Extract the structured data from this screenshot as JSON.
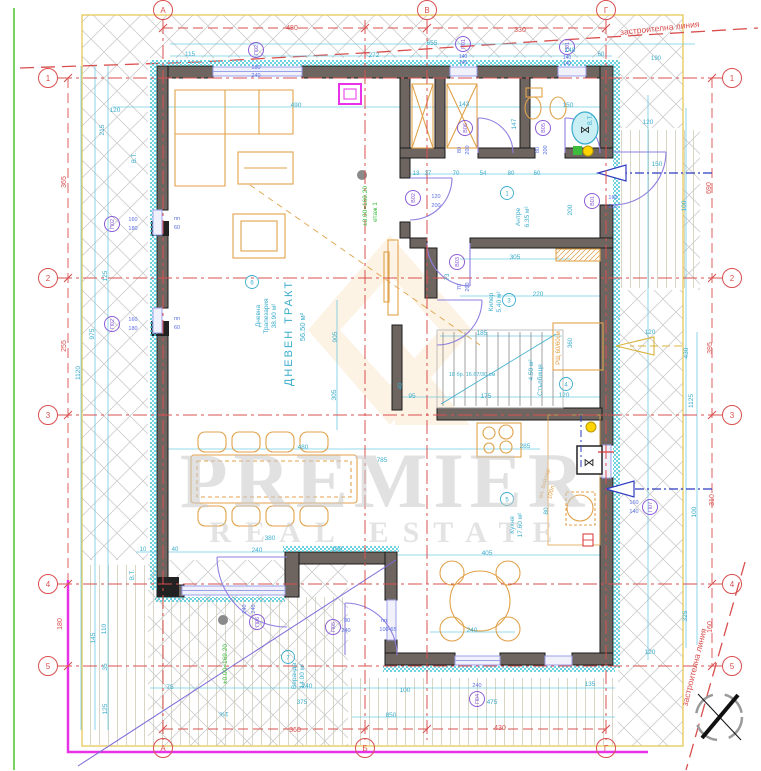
{
  "drawing": {
    "type": "architectural-floor-plan",
    "floor_label": "етаж 1",
    "elevation": "±0.00=169.20"
  },
  "texts": [
    {
      "t": "480",
      "x": 292,
      "y": 30,
      "s": 7,
      "c": "red",
      "n": "dim-red"
    },
    {
      "t": "330",
      "x": 520,
      "y": 32,
      "s": 7,
      "c": "red",
      "n": "dim-red"
    },
    {
      "t": "застроителна линия",
      "x": 660,
      "y": 31,
      "s": 8.5,
      "c": "red",
      "r": -6,
      "n": "building-line-label"
    },
    {
      "t": "застроителна линия",
      "x": 697,
      "y": 668,
      "s": 8.5,
      "c": "red",
      "r": -76,
      "n": "building-line-label"
    },
    {
      "t": "365",
      "x": 66,
      "y": 182,
      "s": 7,
      "c": "red",
      "r": -90,
      "n": "dim-red"
    },
    {
      "t": "255",
      "x": 66,
      "y": 346,
      "s": 7,
      "c": "red",
      "r": -90,
      "n": "dim-red"
    },
    {
      "t": "180",
      "x": 62,
      "y": 624,
      "s": 7,
      "c": "red",
      "r": -90,
      "n": "dim-red"
    },
    {
      "t": "690",
      "x": 711,
      "y": 188,
      "s": 7,
      "c": "red",
      "r": -90,
      "n": "dim-red"
    },
    {
      "t": "395",
      "x": 712,
      "y": 348,
      "s": 7,
      "c": "red",
      "r": -90,
      "n": "dim-red"
    },
    {
      "t": "310",
      "x": 714,
      "y": 500,
      "s": 7,
      "c": "red",
      "r": -90,
      "n": "dim-red"
    },
    {
      "t": "160",
      "x": 712,
      "y": 627,
      "s": 7,
      "c": "red",
      "r": -90,
      "n": "dim-red"
    },
    {
      "t": "360",
      "x": 295,
      "y": 732,
      "s": 7,
      "c": "red",
      "n": "dim-red"
    },
    {
      "t": "430",
      "x": 500,
      "y": 730,
      "s": 7,
      "c": "red",
      "n": "dim-red"
    },
    {
      "t": "115",
      "x": 190,
      "y": 56,
      "s": 6.5,
      "c": "cyan"
    },
    {
      "t": "655",
      "x": 432,
      "y": 45,
      "s": 6.5,
      "c": "cyan"
    },
    {
      "t": "272",
      "x": 374,
      "y": 57,
      "s": 6.5,
      "c": "cyan"
    },
    {
      "t": "148",
      "x": 570,
      "y": 52,
      "s": 6.5,
      "c": "cyan"
    },
    {
      "t": "60",
      "x": 601,
      "y": 56,
      "s": 6,
      "c": "cyan"
    },
    {
      "t": "190",
      "x": 656,
      "y": 60,
      "s": 6,
      "c": "cyan"
    },
    {
      "t": "120",
      "x": 648,
      "y": 124,
      "s": 6.5,
      "c": "cyan"
    },
    {
      "t": "150",
      "x": 657,
      "y": 166,
      "s": 6.5,
      "c": "cyan"
    },
    {
      "t": "100",
      "x": 686,
      "y": 206,
      "s": 6.5,
      "c": "cyan",
      "r": -90
    },
    {
      "t": "В.Т.",
      "x": 592,
      "y": 120,
      "s": 6,
      "c": "cyan",
      "r": -90
    },
    {
      "t": "В.Т.",
      "x": 136,
      "y": 158,
      "s": 6,
      "c": "cyan",
      "r": -90
    },
    {
      "t": "В.Т.",
      "x": 134,
      "y": 575,
      "s": 6,
      "c": "cyan",
      "r": -90
    },
    {
      "t": "120",
      "x": 115,
      "y": 112,
      "s": 6.5,
      "c": "cyan"
    },
    {
      "t": "215",
      "x": 104,
      "y": 130,
      "s": 6.5,
      "c": "cyan",
      "r": -90
    },
    {
      "t": "125",
      "x": 107,
      "y": 276,
      "s": 6.5,
      "c": "cyan",
      "r": -90
    },
    {
      "t": "975",
      "x": 94,
      "y": 334,
      "s": 6.5,
      "c": "cyan",
      "r": -90
    },
    {
      "t": "1120",
      "x": 80,
      "y": 373,
      "s": 6.5,
      "c": "cyan",
      "r": -90
    },
    {
      "t": "110",
      "x": 106,
      "y": 629,
      "s": 6.5,
      "c": "cyan",
      "r": -90
    },
    {
      "t": "145",
      "x": 95,
      "y": 638,
      "s": 6.5,
      "c": "cyan",
      "r": -90
    },
    {
      "t": "35",
      "x": 107,
      "y": 667,
      "s": 6.5,
      "c": "cyan",
      "r": -90
    },
    {
      "t": "125",
      "x": 107,
      "y": 709,
      "s": 6.5,
      "c": "cyan",
      "r": -90
    },
    {
      "t": "490",
      "x": 296,
      "y": 107,
      "s": 6.5,
      "c": "cyan"
    },
    {
      "t": "143",
      "x": 464,
      "y": 106,
      "s": 6.5,
      "c": "cyan"
    },
    {
      "t": "150",
      "x": 568,
      "y": 107,
      "s": 6.5,
      "c": "cyan"
    },
    {
      "t": "147",
      "x": 516,
      "y": 124,
      "s": 6.5,
      "c": "cyan",
      "r": -90
    },
    {
      "t": "905",
      "x": 337,
      "y": 337,
      "s": 6.5,
      "c": "cyan",
      "r": -90
    },
    {
      "t": "305",
      "x": 336,
      "y": 395,
      "s": 6.5,
      "c": "cyan",
      "r": -90
    },
    {
      "t": "13",
      "x": 416,
      "y": 175,
      "s": 6,
      "c": "cyan"
    },
    {
      "t": "37",
      "x": 428,
      "y": 175,
      "s": 6,
      "c": "cyan"
    },
    {
      "t": "70",
      "x": 456,
      "y": 175,
      "s": 6,
      "c": "cyan"
    },
    {
      "t": "54",
      "x": 483,
      "y": 175,
      "s": 6,
      "c": "cyan"
    },
    {
      "t": "80",
      "x": 511,
      "y": 175,
      "s": 6,
      "c": "cyan"
    },
    {
      "t": "60",
      "x": 537,
      "y": 175,
      "s": 6,
      "c": "cyan"
    },
    {
      "t": "200",
      "x": 572,
      "y": 210,
      "s": 6.5,
      "c": "cyan",
      "r": -90
    },
    {
      "t": "305",
      "x": 515,
      "y": 259,
      "s": 6.5,
      "c": "cyan"
    },
    {
      "t": "220",
      "x": 538,
      "y": 296,
      "s": 6.5,
      "c": "cyan"
    },
    {
      "t": "73",
      "x": 449,
      "y": 277,
      "s": 6,
      "c": "cyan",
      "r": -90
    },
    {
      "t": "185",
      "x": 482,
      "y": 335,
      "s": 6.5,
      "c": "cyan"
    },
    {
      "t": "18 бр. 16.67/30 см",
      "x": 472,
      "y": 376,
      "s": 5.5,
      "c": "cyan",
      "n": "stair-note"
    },
    {
      "t": "95",
      "x": 412,
      "y": 398,
      "s": 6.5,
      "c": "cyan"
    },
    {
      "t": "175",
      "x": 486,
      "y": 398,
      "s": 6.5,
      "c": "cyan"
    },
    {
      "t": "120",
      "x": 564,
      "y": 397,
      "s": 6.5,
      "c": "cyan"
    },
    {
      "t": "40",
      "x": 402,
      "y": 386,
      "s": 6,
      "c": "cyan",
      "r": -90
    },
    {
      "t": "360",
      "x": 572,
      "y": 343,
      "s": 6,
      "c": "cyan",
      "r": -90
    },
    {
      "t": "285",
      "x": 525,
      "y": 448,
      "s": 6.5,
      "c": "cyan"
    },
    {
      "t": "405",
      "x": 487,
      "y": 555,
      "s": 6.5,
      "c": "cyan"
    },
    {
      "t": "80",
      "x": 548,
      "y": 511,
      "s": 6.5,
      "c": "cyan",
      "r": -90
    },
    {
      "t": "480",
      "x": 303,
      "y": 449,
      "s": 6.5,
      "c": "cyan"
    },
    {
      "t": "785",
      "x": 382,
      "y": 462,
      "s": 6.5,
      "c": "cyan"
    },
    {
      "t": "380",
      "x": 270,
      "y": 540,
      "s": 6.5,
      "c": "cyan"
    },
    {
      "t": "10",
      "x": 143,
      "y": 551,
      "s": 6,
      "c": "cyan"
    },
    {
      "t": "40",
      "x": 175,
      "y": 551,
      "s": 6,
      "c": "cyan"
    },
    {
      "t": "240",
      "x": 257,
      "y": 552,
      "s": 6.5,
      "c": "cyan"
    },
    {
      "t": "100",
      "x": 337,
      "y": 551,
      "s": 6.5,
      "c": "cyan"
    },
    {
      "t": "75",
      "x": 170,
      "y": 689,
      "s": 6.5,
      "c": "cyan"
    },
    {
      "t": "240",
      "x": 307,
      "y": 688,
      "s": 6.5,
      "c": "cyan"
    },
    {
      "t": "375",
      "x": 302,
      "y": 704,
      "s": 6.5,
      "c": "cyan"
    },
    {
      "t": "850",
      "x": 391,
      "y": 717,
      "s": 6.5,
      "c": "cyan"
    },
    {
      "t": "1%",
      "x": 224,
      "y": 712,
      "s": 6.5,
      "c": "cyan",
      "r": 180,
      "n": "slope-label"
    },
    {
      "t": "100",
      "x": 405,
      "y": 692,
      "s": 6.5,
      "c": "cyan"
    },
    {
      "t": "135",
      "x": 590,
      "y": 686,
      "s": 6.5,
      "c": "cyan"
    },
    {
      "t": "240",
      "x": 472,
      "y": 632,
      "s": 6.5,
      "c": "cyan"
    },
    {
      "t": "475",
      "x": 492,
      "y": 704,
      "s": 6.5,
      "c": "cyan"
    },
    {
      "t": "120",
      "x": 650,
      "y": 654,
      "s": 6.5,
      "c": "cyan"
    },
    {
      "t": "325",
      "x": 687,
      "y": 616,
      "s": 6.5,
      "c": "cyan",
      "r": -90
    },
    {
      "t": "120",
      "x": 650,
      "y": 334,
      "s": 6.5,
      "c": "cyan"
    },
    {
      "t": "430",
      "x": 688,
      "y": 353,
      "s": 6.5,
      "c": "cyan",
      "r": -90
    },
    {
      "t": "1125",
      "x": 693,
      "y": 401,
      "s": 6.5,
      "c": "cyan",
      "r": -90
    },
    {
      "t": "100",
      "x": 696,
      "y": 512,
      "s": 6.5,
      "c": "cyan",
      "r": -90
    },
    {
      "t": "±0.00=169.20",
      "x": 367,
      "y": 206,
      "s": 6.5,
      "c": "green",
      "r": -90,
      "n": "elevation-label"
    },
    {
      "t": "етаж 1",
      "x": 377,
      "y": 212,
      "s": 6.5,
      "c": "green",
      "r": -90,
      "n": "floor-label"
    },
    {
      "t": "±0.00=169.20",
      "x": 227,
      "y": 664,
      "s": 6.5,
      "c": "green",
      "r": -90,
      "n": "elevation-label"
    },
    {
      "t": "ДНЕВЕН ТРАКТ",
      "x": 292,
      "y": 333,
      "s": 11,
      "c": "cyan",
      "r": -90,
      "ls": 2,
      "n": "room-name"
    },
    {
      "t": "56.50 м²",
      "x": 305,
      "y": 327,
      "s": 7.5,
      "c": "cyan",
      "r": -90,
      "n": "room-area"
    },
    {
      "t": "Дневна",
      "x": 260,
      "y": 316,
      "s": 6.5,
      "c": "cyan",
      "r": -90,
      "n": "room-name"
    },
    {
      "t": "Трапезария",
      "x": 268,
      "y": 316,
      "s": 6.5,
      "c": "cyan",
      "r": -90,
      "n": "room-name"
    },
    {
      "t": "38.90 м²",
      "x": 276,
      "y": 316,
      "s": 6.5,
      "c": "cyan",
      "r": -90,
      "n": "room-area"
    },
    {
      "t": "Антре",
      "x": 520,
      "y": 217,
      "s": 6.5,
      "c": "cyan",
      "r": -90,
      "n": "room-name"
    },
    {
      "t": "6.35 м²",
      "x": 529,
      "y": 217,
      "s": 6.5,
      "c": "cyan",
      "r": -90,
      "n": "room-area"
    },
    {
      "t": "Килер",
      "x": 493,
      "y": 302,
      "s": 6.5,
      "c": "cyan",
      "r": -90,
      "n": "room-name"
    },
    {
      "t": "5.40 м²",
      "x": 501,
      "y": 302,
      "s": 6.5,
      "c": "cyan",
      "r": -90,
      "n": "room-area"
    },
    {
      "t": "4.50 м²",
      "x": 533,
      "y": 370,
      "s": 6.5,
      "c": "cyan",
      "r": -90,
      "n": "room-area"
    },
    {
      "t": "Стълбище",
      "x": 542,
      "y": 380,
      "s": 6.5,
      "c": "cyan",
      "r": -90,
      "n": "room-name"
    },
    {
      "t": "Кухня",
      "x": 514,
      "y": 525,
      "s": 6.5,
      "c": "cyan",
      "r": -90,
      "n": "room-name"
    },
    {
      "t": "17.60 м²",
      "x": 522,
      "y": 525,
      "s": 6.5,
      "c": "cyan",
      "r": -90,
      "n": "room-area"
    },
    {
      "t": "Веранда",
      "x": 296,
      "y": 676,
      "s": 6.5,
      "c": "cyan",
      "r": -90,
      "n": "room-name"
    },
    {
      "t": "14.00 м²",
      "x": 304,
      "y": 676,
      "s": 6.5,
      "c": "cyan",
      "r": -90,
      "n": "room-area"
    },
    {
      "t": "ел. бойлер",
      "x": 546,
      "y": 484,
      "s": 6,
      "c": "orange",
      "r": -75,
      "n": "boiler-label"
    },
    {
      "t": "100л.",
      "x": 553,
      "y": 492,
      "s": 6,
      "c": "orange",
      "r": -75,
      "n": "boiler-label"
    },
    {
      "t": "РЩ 60/60см",
      "x": 560,
      "y": 348,
      "s": 6,
      "c": "orange",
      "r": -90,
      "n": "panel-label"
    },
    {
      "t": "пп",
      "x": 177,
      "y": 220,
      "s": 5.5,
      "c": "blue"
    },
    {
      "t": "60",
      "x": 177,
      "y": 229,
      "s": 5.5,
      "c": "blue"
    },
    {
      "t": "пп",
      "x": 177,
      "y": 320,
      "s": 5.5,
      "c": "blue"
    },
    {
      "t": "60",
      "x": 177,
      "y": 329,
      "s": 5.5,
      "c": "blue"
    },
    {
      "t": "пп",
      "x": 384,
      "y": 622,
      "s": 5.5,
      "c": "blue"
    },
    {
      "t": "100-65",
      "x": 388,
      "y": 631,
      "s": 5.5,
      "c": "blue"
    },
    {
      "t": "180",
      "x": 256,
      "y": 69,
      "s": 5.5,
      "c": "blue"
    },
    {
      "t": "240",
      "x": 256,
      "y": 77,
      "s": 5.5,
      "c": "blue"
    },
    {
      "t": "140",
      "x": 463,
      "y": 58,
      "s": 5,
      "c": "blue"
    },
    {
      "t": "140",
      "x": 463,
      "y": 64,
      "s": 5,
      "c": "blue"
    },
    {
      "t": "140",
      "x": 567,
      "y": 59,
      "s": 5,
      "c": "blue"
    },
    {
      "t": "140",
      "x": 567,
      "y": 65,
      "s": 5,
      "c": "blue"
    },
    {
      "t": "160",
      "x": 133,
      "y": 221,
      "s": 5.5,
      "c": "blue"
    },
    {
      "t": "180",
      "x": 133,
      "y": 230,
      "s": 5.5,
      "c": "blue"
    },
    {
      "t": "160",
      "x": 133,
      "y": 321,
      "s": 5.5,
      "c": "blue"
    },
    {
      "t": "180",
      "x": 133,
      "y": 330,
      "s": 5.5,
      "c": "blue"
    },
    {
      "t": "160",
      "x": 634,
      "y": 504,
      "s": 5.5,
      "c": "blue"
    },
    {
      "t": "140",
      "x": 634,
      "y": 513,
      "s": 5.5,
      "c": "blue"
    },
    {
      "t": "240",
      "x": 246,
      "y": 609,
      "s": 5.5,
      "c": "blue",
      "r": -90
    },
    {
      "t": "240",
      "x": 255,
      "y": 609,
      "s": 5.5,
      "c": "blue",
      "r": -90
    },
    {
      "t": "80",
      "x": 347,
      "y": 622,
      "s": 5.5,
      "c": "blue"
    },
    {
      "t": "240",
      "x": 346,
      "y": 632,
      "s": 5.5,
      "c": "blue"
    },
    {
      "t": "240",
      "x": 477,
      "y": 687,
      "s": 5.5,
      "c": "blue"
    },
    {
      "t": "80",
      "x": 461,
      "y": 150,
      "s": 5.5,
      "c": "blue",
      "r": -90
    },
    {
      "t": "200",
      "x": 469,
      "y": 150,
      "s": 5.5,
      "c": "blue",
      "r": -90
    },
    {
      "t": "80",
      "x": 539,
      "y": 150,
      "s": 5.5,
      "c": "blue",
      "r": -90
    },
    {
      "t": "200",
      "x": 547,
      "y": 150,
      "s": 5.5,
      "c": "blue",
      "r": -90
    },
    {
      "t": "120",
      "x": 436,
      "y": 198,
      "s": 5.5,
      "c": "blue"
    },
    {
      "t": "200",
      "x": 436,
      "y": 207,
      "s": 5.5,
      "c": "blue"
    },
    {
      "t": "70",
      "x": 461,
      "y": 287,
      "s": 5.5,
      "c": "blue",
      "r": -90
    },
    {
      "t": "200",
      "x": 469,
      "y": 287,
      "s": 5.5,
      "c": "blue",
      "r": -90
    },
    {
      "t": "160",
      "x": 613,
      "y": 199,
      "s": 5.5,
      "c": "blue"
    },
    {
      "t": "210",
      "x": 613,
      "y": 208,
      "s": 5.5,
      "c": "blue"
    },
    {
      "t": "⋈",
      "x": 589,
      "y": 466,
      "s": 11,
      "c": "black",
      "n": "sink-symbol"
    },
    {
      "t": "⋈",
      "x": 585,
      "y": 133,
      "s": 10,
      "c": "black",
      "n": "basin-symbol"
    },
    {
      "t": "PREMIER",
      "x": 385,
      "y": 507,
      "s": 78,
      "c": "gray",
      "ls": 6,
      "o": 0.55,
      "f": "serif",
      "n": "watermark-line1"
    },
    {
      "t": "REAL ESTATE",
      "x": 388,
      "y": 542,
      "s": 30,
      "c": "gray",
      "ls": 14,
      "o": 0.5,
      "f": "serif",
      "n": "watermark-line2"
    }
  ],
  "tags": [
    {
      "t": "П02",
      "x": 256,
      "y": 50
    },
    {
      "t": "П01",
      "x": 463,
      "y": 44
    },
    {
      "t": "П01",
      "x": 567,
      "y": 47
    },
    {
      "t": "П02",
      "x": 112,
      "y": 224
    },
    {
      "t": "П02",
      "x": 112,
      "y": 324
    },
    {
      "t": "П07",
      "x": 650,
      "y": 507
    },
    {
      "t": "П06",
      "x": 257,
      "y": 622
    },
    {
      "t": "П05",
      "x": 333,
      "y": 627
    },
    {
      "t": "П04",
      "x": 477,
      "y": 699
    },
    {
      "t": "В06",
      "x": 465,
      "y": 128
    },
    {
      "t": "В05",
      "x": 543,
      "y": 128
    },
    {
      "t": "В02",
      "x": 413,
      "y": 198
    },
    {
      "t": "В03",
      "x": 457,
      "y": 262
    },
    {
      "t": "В01",
      "x": 592,
      "y": 201
    }
  ],
  "room_markers": [
    {
      "t": "6",
      "x": 252,
      "y": 282
    },
    {
      "t": "1",
      "x": 507,
      "y": 193
    },
    {
      "t": "3",
      "x": 509,
      "y": 300
    },
    {
      "t": "4",
      "x": 566,
      "y": 384
    },
    {
      "t": "5",
      "x": 507,
      "y": 499
    },
    {
      "t": "7",
      "x": 288,
      "y": 657
    }
  ],
  "grid": {
    "rows": [
      {
        "t": "1",
        "y": 78
      },
      {
        "t": "2",
        "y": 278
      },
      {
        "t": "3",
        "y": 415
      },
      {
        "t": "4",
        "y": 584
      },
      {
        "t": "5",
        "y": 666
      }
    ],
    "cols": [
      {
        "t": "А",
        "x": 163,
        "top": true,
        "bottom": true
      },
      {
        "t": "Б",
        "x": 365,
        "top": false,
        "bottom": true
      },
      {
        "t": "В",
        "x": 427,
        "top": true,
        "bottom": false
      },
      {
        "t": "Г",
        "x": 606,
        "top": true,
        "bottom": true
      }
    ]
  },
  "colors": {
    "red": "#d94f4f",
    "cyan": "#3aaccb",
    "blue": "#5b6ee1",
    "purple": "#8b5cd6",
    "orange": "#e09a3f",
    "green": "#3dbb3d",
    "magenta": "#e832e8",
    "gray": "#c9c9c9",
    "wall": "#6e6561",
    "teal": "#49c8d8",
    "yellow_boundary": "#e6c34a"
  }
}
